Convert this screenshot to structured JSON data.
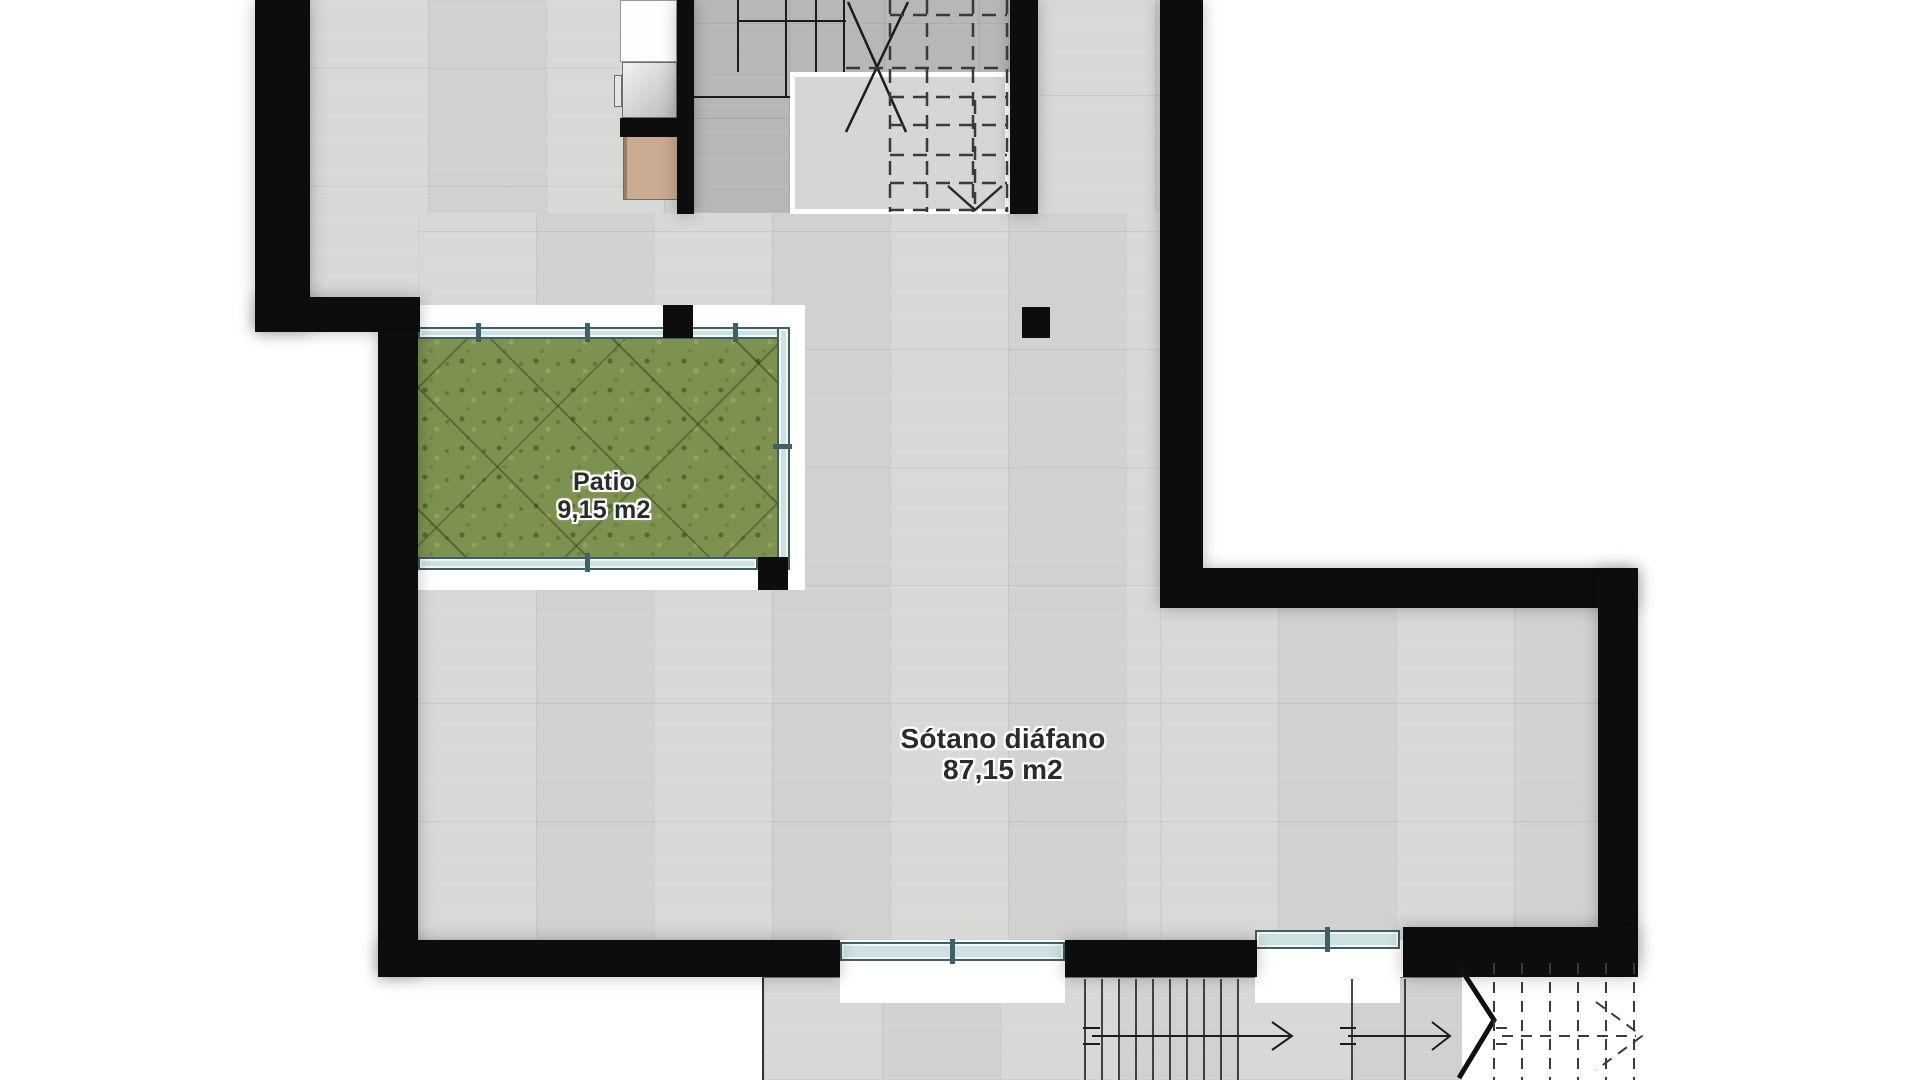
{
  "document": {
    "type": "architectural floor plan",
    "level": "basement"
  },
  "labels": {
    "patio": {
      "name": "Patio",
      "area": "9,15 m2"
    },
    "basement": {
      "name": "Sótano diáfano",
      "area": "87,15 m2"
    }
  },
  "colors": {
    "wall": "#0d0d0d",
    "floor": "#d8d8d6",
    "floor_dark": "#b7b7b5",
    "landing": "#d6d6d4",
    "grass": "#7d9150",
    "railing_fill": "#cfe0e0",
    "railing_border": "#3f6068",
    "appliance_tan": "#c8ab91",
    "appliance_gray": "#e2e2e2",
    "line": "#1c1c1c",
    "label_text": "#2b2b2b",
    "background": "#ffffff"
  }
}
